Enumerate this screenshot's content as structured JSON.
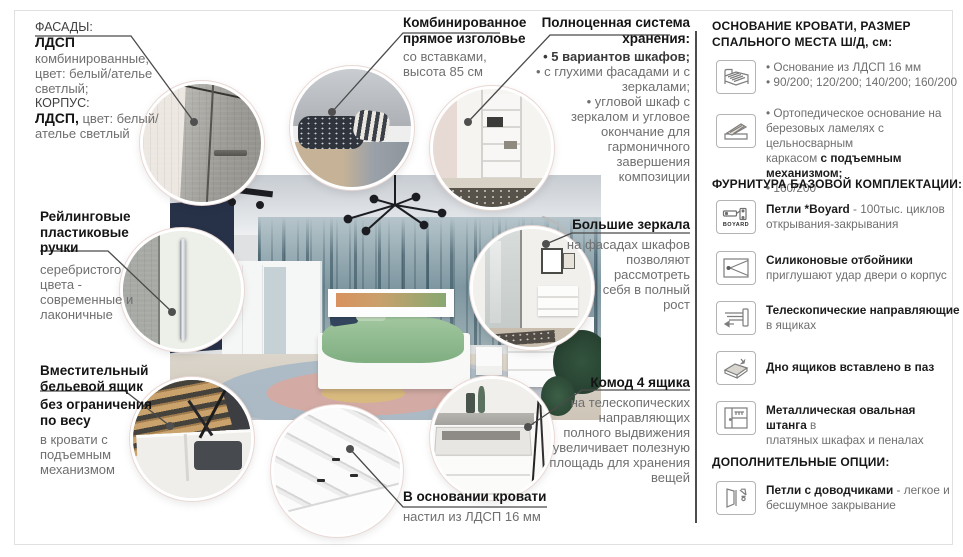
{
  "colors": {
    "text_dark": "#1c1c1c",
    "text_gray": "#6f6f6f",
    "pointer_line": "#4a4a4a",
    "divider": "#4d4d4d",
    "mural_teal": "#7e97a1",
    "duvet_green": "#8fbd8c",
    "navy_wall": "#273148"
  },
  "callouts": {
    "facades": {
      "label": "ФАСАДЫ:",
      "t1": "ЛДСП",
      "l1": "комбинированные,",
      "l2": "цвет: белый/ателье",
      "l3": "светлый;",
      "label2": "КОРПУС:",
      "t2": "ЛДСП,",
      "l4": "цвет: белый/",
      "l5": "ателье светлый"
    },
    "handles": {
      "t1": "Рейлинговые",
      "t2": "пластиковые",
      "t3": "ручки",
      "l1": "серебристого",
      "l2": "цвета -",
      "l3": "современные и",
      "l4": "лаконичные"
    },
    "drawer_box": {
      "t1": "Вместительный",
      "t2": "бельевой ящик",
      "t3": "без ограничения",
      "t4": "по весу",
      "l1": "в кровати с",
      "l2": "подъемным",
      "l3": "механизмом"
    },
    "headboard": {
      "t1": "Комбинированное",
      "t2": "прямое изголовье",
      "l1": "со вставками,",
      "l2": "высота 85 см"
    },
    "storage": {
      "t1": "Полноценная система",
      "t2": "хранения:",
      "b1": "• 5 вариантов шкафов;",
      "b2": "• с глухими фасадами и с",
      "b3": "зеркалами;",
      "b4": "• угловой шкаф с",
      "b5": "зеркалом и угловое",
      "b6": "окончание для",
      "b7": "гармоничного",
      "b8": "завершения",
      "b9": "композиции"
    },
    "mirrors": {
      "t1": "Большие зеркала",
      "l1": "на фасадах шкафов",
      "l2": "позволяют",
      "l3": "рассмотреть",
      "l4": "себя в полный",
      "l5": "рост"
    },
    "commode": {
      "t1": "Комод 4 ящика",
      "l1": "на телескопических",
      "l2": "направляющих",
      "l3": "полного выдвижения",
      "l4": "увеличивает полезную",
      "l5": "площадь для хранения",
      "l6": "вещей"
    },
    "bed_base": {
      "t1": "В основании кровати",
      "l1": "настил из ЛДСП 16 мм"
    }
  },
  "panel": {
    "header_base_1": "ОСНОВАНИЕ КРОВАТИ, РАЗМЕР",
    "header_base_2": "СПАЛЬНОГО МЕСТА Ш/Д, см:",
    "base1": {
      "icon": "bed-icon",
      "l1": "• Основание из ЛДСП 16 мм",
      "l2": "• 90/200; 120/200; 140/200; 160/200"
    },
    "base2": {
      "icon": "lift-bed-icon",
      "l1": "• Ортопедическое основание на",
      "l2": "березовых ламелях с цельносварным",
      "l3a": "каркасом ",
      "l3b": "с подъемным механизмом;",
      "l4": "• 160/200"
    },
    "header_hardware": "ФУРНИТУРА БАЗОВОЙ КОМПЛЕКТАЦИИ:",
    "hw1": {
      "icon": "hinge-boyard-icon",
      "icon_label": "BOYARD",
      "bold": "Петли *Boyard",
      "rest": " - 100тыс. циклов",
      "l2": "открывания-закрывания"
    },
    "hw2": {
      "icon": "silicone-bumper-icon",
      "bold": "Силиконовые отбойники",
      "l2": "приглушают удар двери о корпус"
    },
    "hw3": {
      "icon": "telescopic-rails-icon",
      "bold": "Телескопические направляющие",
      "l2": "в ящиках"
    },
    "hw4": {
      "icon": "drawer-bottom-icon",
      "bold": "Дно ящиков вставлено в паз"
    },
    "hw5": {
      "icon": "oval-rod-icon",
      "bold": "Металлическая овальная штанга",
      "rest": " в",
      "l2": "платяных шкафах и пеналах"
    },
    "header_options": "ДОПОЛНИТЕЛЬНЫЕ ОПЦИИ:",
    "opt1": {
      "icon": "soft-close-hinge-icon",
      "bold": "Петли с доводчиками",
      "rest": " - легкое и",
      "l2": "бесшумное закрывание"
    }
  }
}
